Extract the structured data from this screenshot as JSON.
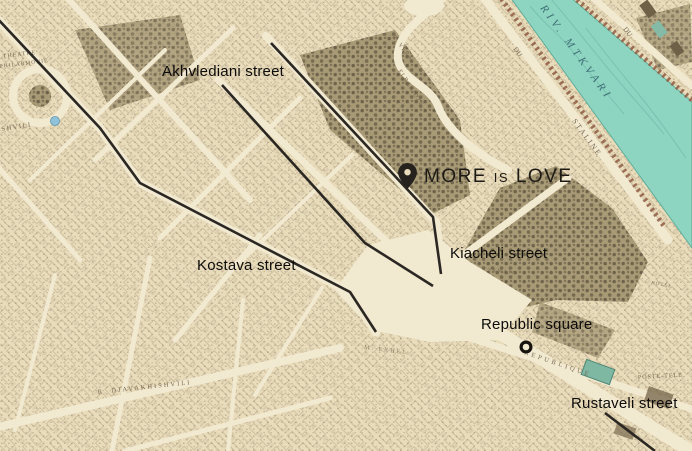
{
  "overlay": {
    "labels": {
      "akhvlediani": "Akhvlediani street",
      "kostava": "Kostava street",
      "kiacheli": "Kiacheli street",
      "republic_square": "Republic square",
      "rustaveli": "Rustaveli street",
      "venue": "MORE is LOVE"
    },
    "markers": {
      "venue_pin_color": "#26221d",
      "republic_ring_color": "#17130e"
    },
    "street_line_color": "#2b2722"
  },
  "base_map": {
    "colors": {
      "paper": "#e9dcbb",
      "street": "#f2e9d1",
      "river": "#8ed5c1",
      "river_wave": "#66b7a4",
      "bank_trees": "#8f5c44",
      "engraved_text": "#77684f",
      "river_text": "#3f6f76"
    },
    "texts": [
      {
        "text": "THEATRE"
      },
      {
        "text": "PHILARMONIE"
      },
      {
        "text": "SHVILI"
      },
      {
        "text": "R. VERA"
      },
      {
        "text": "ELBAKIDZE"
      },
      {
        "text": "RIV. MTKVARI"
      },
      {
        "text": "STALINE"
      },
      {
        "text": "DU"
      },
      {
        "text": "DU"
      },
      {
        "text": "R. DJAVAKHISHVILI"
      },
      {
        "text": "REPUBLIQUE"
      },
      {
        "text": "POSTE-TELE"
      },
      {
        "text": "SAMAIA"
      },
      {
        "text": "M. EKHEL"
      },
      {
        "text": "HOTEL"
      }
    ]
  }
}
